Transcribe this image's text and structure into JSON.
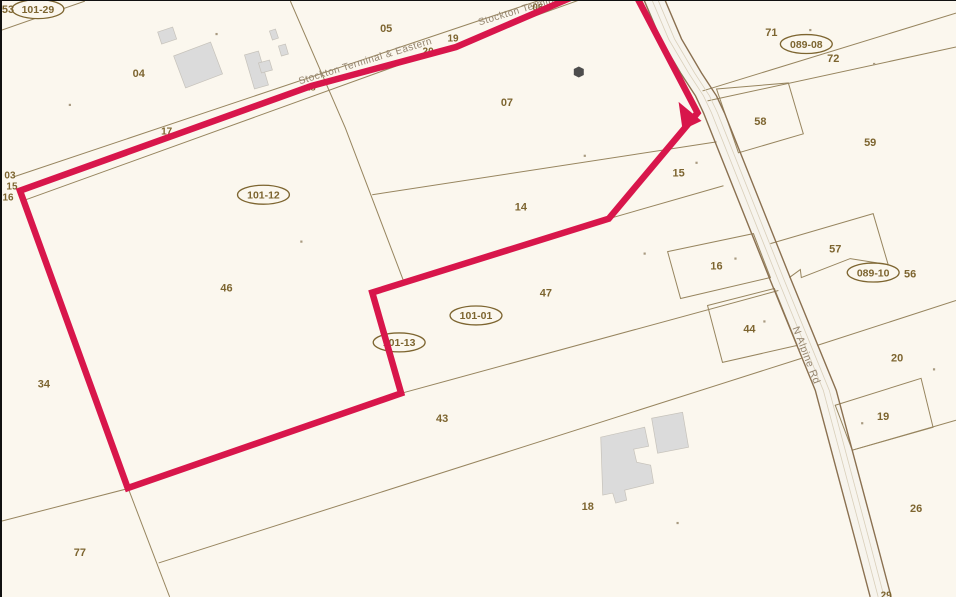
{
  "map": {
    "colors": {
      "background": "#fbf7ee",
      "parcel_line": "#97855f",
      "road_edge": "#8a7050",
      "road_fill": "#f7f4ed",
      "road_center": "#d9cfba",
      "highlight": "#d8164b",
      "label": "#7d6530",
      "muted_label": "#94846e",
      "building": "#dbdbdb",
      "building_edge": "#c6c2ba",
      "structure_dark": "#4d4d4d",
      "dot": "#a89a80"
    },
    "labels": [
      {
        "t": "53",
        "x": 6,
        "y": 8,
        "s": 11
      },
      {
        "t": "04",
        "x": 137,
        "y": 72,
        "s": 11
      },
      {
        "t": "05",
        "x": 385,
        "y": 27,
        "s": 11
      },
      {
        "t": "19",
        "x": 452,
        "y": 37,
        "s": 10
      },
      {
        "t": "06",
        "x": 537,
        "y": 6,
        "s": 10
      },
      {
        "t": "20",
        "x": 427,
        "y": 50,
        "s": 10
      },
      {
        "t": "18",
        "x": 309,
        "y": 86,
        "s": 9.5
      },
      {
        "t": "17",
        "x": 165,
        "y": 130,
        "s": 10
      },
      {
        "t": "07",
        "x": 506,
        "y": 101,
        "s": 11
      },
      {
        "t": "71",
        "x": 771,
        "y": 31,
        "s": 11
      },
      {
        "t": "72",
        "x": 833,
        "y": 57,
        "s": 11
      },
      {
        "t": "58",
        "x": 760,
        "y": 120,
        "s": 11
      },
      {
        "t": "59",
        "x": 870,
        "y": 141,
        "s": 11
      },
      {
        "t": "15",
        "x": 678,
        "y": 172,
        "s": 11
      },
      {
        "t": "03",
        "x": 8,
        "y": 174,
        "s": 10
      },
      {
        "t": "15",
        "x": 10,
        "y": 185,
        "s": 10
      },
      {
        "t": "16",
        "x": 6,
        "y": 196,
        "s": 10
      },
      {
        "t": "14",
        "x": 520,
        "y": 206,
        "s": 11
      },
      {
        "t": "46",
        "x": 225,
        "y": 287,
        "s": 11
      },
      {
        "t": "16",
        "x": 716,
        "y": 265,
        "s": 11
      },
      {
        "t": "57",
        "x": 835,
        "y": 248,
        "s": 11
      },
      {
        "t": "56",
        "x": 910,
        "y": 273,
        "s": 11
      },
      {
        "t": "47",
        "x": 545,
        "y": 292,
        "s": 11
      },
      {
        "t": "44",
        "x": 749,
        "y": 328,
        "s": 11
      },
      {
        "t": "20",
        "x": 897,
        "y": 357,
        "s": 11
      },
      {
        "t": "34",
        "x": 42,
        "y": 383,
        "s": 11
      },
      {
        "t": "43",
        "x": 441,
        "y": 418,
        "s": 11
      },
      {
        "t": "19",
        "x": 883,
        "y": 416,
        "s": 11
      },
      {
        "t": "18",
        "x": 587,
        "y": 506,
        "s": 11
      },
      {
        "t": "26",
        "x": 916,
        "y": 508,
        "s": 11
      },
      {
        "t": "77",
        "x": 78,
        "y": 552,
        "s": 11
      },
      {
        "t": "29",
        "x": 886,
        "y": 595,
        "s": 10
      }
    ],
    "oval_labels": [
      {
        "t": "101-29",
        "x": 36,
        "y": 8
      },
      {
        "t": "089-08",
        "x": 806,
        "y": 43
      },
      {
        "t": "101-12",
        "x": 262,
        "y": 194
      },
      {
        "t": "089-10",
        "x": 873,
        "y": 272
      },
      {
        "t": "101-01",
        "x": 475,
        "y": 315
      },
      {
        "t": "101-13",
        "x": 398,
        "y": 342
      }
    ],
    "rotated_labels": [
      {
        "t": "Stockton Terminal & Eastern",
        "x": 365,
        "y": 63,
        "a": -17,
        "s": 10
      },
      {
        "t": "Stockton Terminal & Eastern",
        "x": 545,
        "y": 4,
        "a": -17,
        "s": 10
      },
      {
        "t": "N Alpine Rd",
        "x": 803,
        "y": 356,
        "a": 69,
        "s": 10.5
      }
    ],
    "lines": [
      {
        "pts": [
          [
            83,
            0
          ],
          [
            0,
            29
          ]
        ]
      },
      {
        "pts": [
          [
            12,
            176
          ],
          [
            578,
            -14
          ]
        ]
      },
      {
        "pts": [
          [
            24,
            199
          ],
          [
            592,
            -6
          ]
        ]
      },
      {
        "pts": [
          [
            289,
            0
          ],
          [
            344,
            127
          ],
          [
            403,
            282
          ]
        ]
      },
      {
        "pts": [
          [
            371,
            194
          ],
          [
            716,
            141
          ]
        ]
      },
      {
        "pts": [
          [
            608,
            218
          ],
          [
            723,
            185
          ]
        ]
      },
      {
        "pts": [
          [
            702,
            90
          ],
          [
            956,
            12
          ]
        ]
      },
      {
        "pts": [
          [
            707,
            100
          ],
          [
            956,
            46
          ]
        ]
      },
      {
        "pts": [
          [
            770,
            243
          ],
          [
            873,
            213
          ],
          [
            888,
            264
          ]
        ]
      },
      {
        "pts": [
          [
            789,
            277
          ],
          [
            800,
            269
          ],
          [
            801,
            277
          ],
          [
            850,
            258
          ],
          [
            888,
            264
          ]
        ]
      },
      {
        "pts": [
          [
            817,
            345
          ],
          [
            956,
            300
          ]
        ]
      },
      {
        "pts": [
          [
            400,
            393
          ],
          [
            778,
            290
          ]
        ]
      },
      {
        "pts": [
          [
            157,
            563
          ],
          [
            801,
            358
          ]
        ]
      },
      {
        "pts": [
          [
            0,
            521
          ],
          [
            128,
            488
          ]
        ]
      },
      {
        "pts": [
          [
            126,
            487
          ],
          [
            168,
            597
          ]
        ]
      },
      {
        "pts": [
          [
            852,
            450
          ],
          [
            956,
            420
          ]
        ]
      }
    ],
    "parcel_boxes": [
      {
        "pts": [
          [
            716,
            88
          ],
          [
            788,
            82
          ],
          [
            803,
            133
          ],
          [
            738,
            152
          ]
        ]
      },
      {
        "pts": [
          [
            667,
            251
          ],
          [
            753,
            233
          ],
          [
            770,
            277
          ],
          [
            680,
            298
          ]
        ]
      },
      {
        "pts": [
          [
            707,
            305
          ],
          [
            774,
            288
          ],
          [
            797,
            345
          ],
          [
            722,
            362
          ]
        ]
      },
      {
        "pts": [
          [
            835,
            405
          ],
          [
            921,
            378
          ],
          [
            933,
            427
          ],
          [
            852,
            450
          ]
        ]
      }
    ],
    "road": {
      "left": [
        [
          643,
          -2
        ],
        [
          660,
          38
        ],
        [
          680,
          72
        ],
        [
          695,
          95
        ],
        [
          703,
          112
        ],
        [
          770,
          280
        ],
        [
          815,
          390
        ],
        [
          855,
          540
        ],
        [
          870,
          597
        ]
      ],
      "right": [
        [
          664,
          -2
        ],
        [
          681,
          38
        ],
        [
          701,
          72
        ],
        [
          716,
          95
        ],
        [
          724,
          112
        ],
        [
          791,
          280
        ],
        [
          836,
          390
        ],
        [
          876,
          540
        ],
        [
          891,
          597
        ]
      ],
      "centers": [
        [
          [
            651,
            -2
          ],
          [
            668,
            38
          ],
          [
            688,
            72
          ],
          [
            703,
            95
          ],
          [
            711,
            112
          ],
          [
            778,
            280
          ],
          [
            823,
            390
          ],
          [
            863,
            540
          ],
          [
            878,
            597
          ]
        ],
        [
          [
            657,
            -2
          ],
          [
            674,
            38
          ],
          [
            694,
            72
          ],
          [
            709,
            95
          ],
          [
            717,
            112
          ],
          [
            784,
            280
          ],
          [
            829,
            390
          ],
          [
            869,
            540
          ],
          [
            884,
            597
          ]
        ]
      ]
    },
    "buildings": [
      {
        "pts": [
          [
            172,
            55
          ],
          [
            209,
            41
          ],
          [
            221,
            73
          ],
          [
            184,
            87
          ]
        ]
      },
      {
        "pts": [
          [
            156,
            31
          ],
          [
            171,
            26
          ],
          [
            175,
            38
          ],
          [
            160,
            43
          ]
        ]
      },
      {
        "pts": [
          [
            243,
            54
          ],
          [
            257,
            50
          ],
          [
            267,
            84
          ],
          [
            253,
            88
          ]
        ]
      },
      {
        "pts": [
          [
            257,
            62
          ],
          [
            268,
            59
          ],
          [
            271,
            69
          ],
          [
            260,
            72
          ]
        ]
      },
      {
        "pts": [
          [
            268,
            30
          ],
          [
            274,
            28
          ],
          [
            277,
            37
          ],
          [
            271,
            39
          ]
        ]
      },
      {
        "pts": [
          [
            277,
            45
          ],
          [
            284,
            43
          ],
          [
            287,
            53
          ],
          [
            280,
            55
          ]
        ]
      },
      {
        "pts": [
          [
            600,
            437
          ],
          [
            644,
            427
          ],
          [
            648,
            446
          ],
          [
            633,
            449
          ],
          [
            636,
            462
          ],
          [
            650,
            465
          ],
          [
            653,
            483
          ],
          [
            624,
            490
          ],
          [
            626,
            500
          ],
          [
            615,
            503
          ],
          [
            612,
            493
          ],
          [
            602,
            495
          ]
        ]
      },
      {
        "pts": [
          [
            651,
            418
          ],
          [
            682,
            412
          ],
          [
            688,
            447
          ],
          [
            657,
            453
          ]
        ]
      }
    ],
    "hexagon": {
      "pts": [
        [
          578,
          65.5
        ],
        [
          583,
          68
        ],
        [
          583,
          74
        ],
        [
          578,
          76.5
        ],
        [
          573,
          74
        ],
        [
          573,
          68
        ]
      ]
    },
    "highlight_boundary": {
      "pts": [
        [
          18,
          190
        ],
        [
          310,
          85
        ],
        [
          455,
          46
        ],
        [
          590,
          -12
        ],
        [
          632,
          -12
        ],
        [
          697,
          112
        ],
        [
          608,
          218
        ],
        [
          371,
          292
        ],
        [
          400,
          393
        ],
        [
          126,
          488
        ]
      ],
      "width": 6.5
    },
    "arrowhead": {
      "pts": [
        [
          701,
          120
        ],
        [
          678,
          101
        ],
        [
          682,
          129
        ]
      ]
    },
    "dots": [
      [
        68,
        104
      ],
      [
        215,
        33
      ],
      [
        300,
        241
      ],
      [
        584,
        155
      ],
      [
        696,
        162
      ],
      [
        810,
        29
      ],
      [
        874,
        63
      ],
      [
        644,
        253
      ],
      [
        735,
        258
      ],
      [
        764,
        321
      ],
      [
        897,
        271
      ],
      [
        934,
        369
      ],
      [
        862,
        423
      ],
      [
        677,
        523
      ]
    ]
  }
}
